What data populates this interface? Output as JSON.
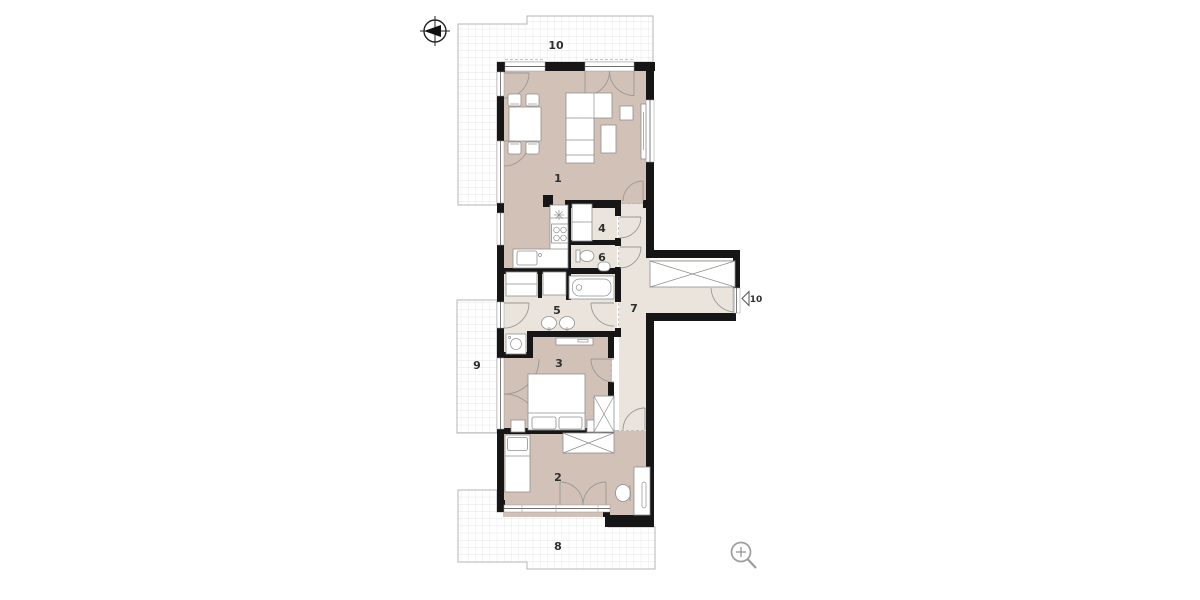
{
  "page": {
    "background": "#ffffff"
  },
  "colors": {
    "room_fill": "#d2c1b6",
    "hall_fill": "#eae4dc",
    "wall": "#161616",
    "terrace_border": "#b4b4b4",
    "grid_line": "#dcdcdc",
    "furniture_stroke": "#8f8f8f",
    "door_arc": "#999999",
    "label": "#2f2f2f",
    "icon_gray": "#9c9c9c"
  },
  "plan": {
    "rooms": [
      {
        "id": "living-room",
        "label": "1"
      },
      {
        "id": "bedroom-main",
        "label": "2"
      },
      {
        "id": "bedroom-second",
        "label": "3"
      },
      {
        "id": "storage",
        "label": "4"
      },
      {
        "id": "bathroom",
        "label": "5"
      },
      {
        "id": "wc",
        "label": "6"
      },
      {
        "id": "hallway",
        "label": "7"
      },
      {
        "id": "terrace-south",
        "label": "8"
      },
      {
        "id": "terrace-west",
        "label": "9"
      },
      {
        "id": "terrace-north",
        "label": "10"
      }
    ],
    "entrance_marker": {
      "label": "10"
    }
  },
  "icons": [
    {
      "name": "north-arrow-icon"
    },
    {
      "name": "zoom-in-icon"
    }
  ]
}
